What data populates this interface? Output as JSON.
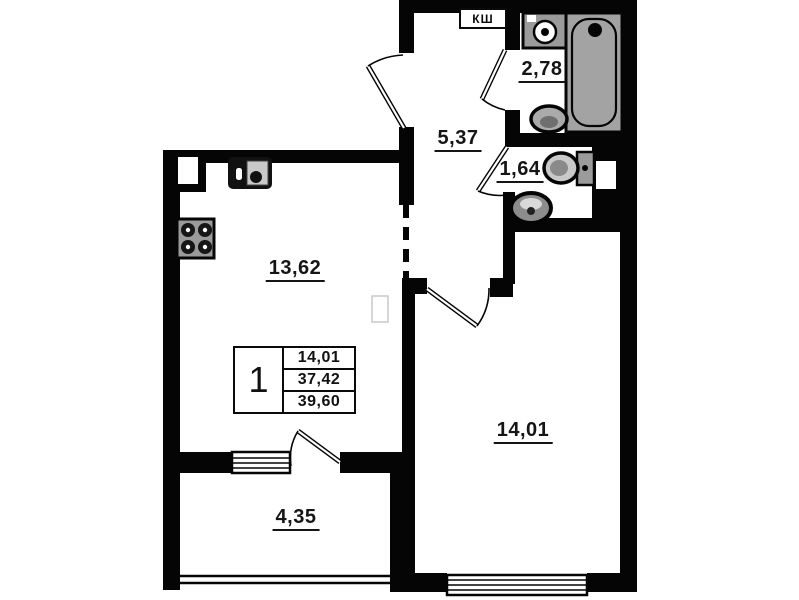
{
  "plan": {
    "type": "apartment-floor-plan",
    "labels": {
      "electrical_box": "КШ",
      "kitchen_area": "13,62",
      "hallway_area": "5,37",
      "bathroom_area": "2,78",
      "wc_area": "1,64",
      "living_room_area": "14,01",
      "balcony_area": "4,35"
    },
    "info_table": {
      "rooms_count": "1",
      "living_area": "14,01",
      "area_without_balcony": "37,42",
      "total_area": "39,60"
    },
    "fixtures": [
      "washing-machine",
      "bathtub",
      "bathroom-sink",
      "toilet",
      "wc-sink",
      "kitchen-sink",
      "stove",
      "radiator"
    ],
    "colors": {
      "wall": "#050505",
      "fixture_gray": "#a3a3a3",
      "background": "#ffffff",
      "text": "#151515"
    }
  }
}
